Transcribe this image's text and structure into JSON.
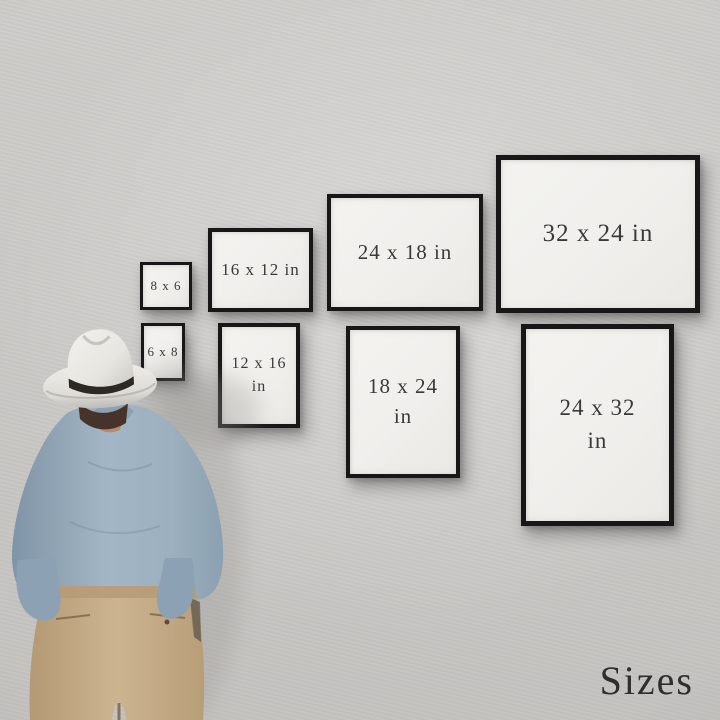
{
  "caption": {
    "text": "Sizes"
  },
  "frames": [
    {
      "name": "8x6",
      "orientation": "landscape",
      "line1": "8 x 6",
      "line2": ""
    },
    {
      "name": "16x12",
      "orientation": "landscape",
      "line1": "16 x 12 in",
      "line2": ""
    },
    {
      "name": "24x18",
      "orientation": "landscape",
      "line1": "24 x 18 in",
      "line2": ""
    },
    {
      "name": "32x24",
      "orientation": "landscape",
      "line1": "32 x 24 in",
      "line2": ""
    },
    {
      "name": "6x8",
      "orientation": "portrait",
      "line1": "6 x 8",
      "line2": ""
    },
    {
      "name": "12x16",
      "orientation": "portrait",
      "line1": "12 x 16",
      "line2": "in"
    },
    {
      "name": "18x24",
      "orientation": "portrait",
      "line1": "18 x 24",
      "line2": "in"
    },
    {
      "name": "24x32",
      "orientation": "portrait",
      "line1": "24 x 32",
      "line2": "in"
    }
  ],
  "colors": {
    "wall": "#cbc9c6",
    "frame_border": "#171717",
    "frame_paper": "#f1f0ed",
    "frame_text": "#3a3a3a",
    "caption_text": "#2e2e2e",
    "hat": "#eae8e3",
    "hat_band": "#2c2824",
    "hair": "#46342a",
    "shirt": "#9db0c0",
    "trousers": "#c3ab87"
  }
}
